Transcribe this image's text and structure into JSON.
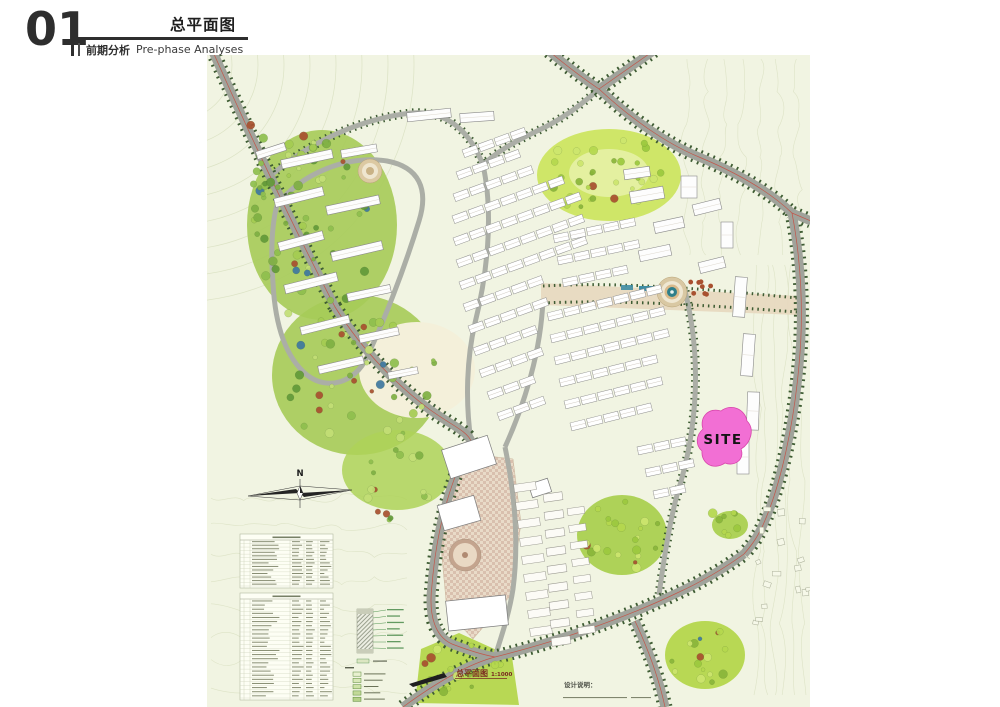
{
  "header": {
    "index": "01",
    "title_cn": "总平面图",
    "section_cn": "前期分析",
    "section_en": "Pre-phase Analyses"
  },
  "map": {
    "site_label": "SITE",
    "compass_label": "N",
    "caption_cn": "总平面图",
    "caption_scale": "1:1000",
    "notes_title": "设计说明：",
    "legend_rows": 5,
    "indicator_tables": 2,
    "indicator_table_rows": [
      13,
      24
    ],
    "colors": {
      "map_base": "#f1f4e2",
      "contour": "#d8dfbf",
      "road_gray": "#a0a39b",
      "road_minor_gray": "#abaea6",
      "tree_line_green": "#3e5c33",
      "centerline_red": "#c2574b",
      "forest_green": "#a6cb58",
      "lawn_green": "#b8d854",
      "park_green": "#cfe668",
      "plaza_tan": "#e7d9c0",
      "checker_tan": "#d9c0ae",
      "site_pink": "#f26fd4",
      "site_pink_edge": "#d846ab",
      "accent_red_tree": "#a8502f",
      "pool_blue": "#3f8da4",
      "caption_red": "#7a2a20"
    }
  }
}
